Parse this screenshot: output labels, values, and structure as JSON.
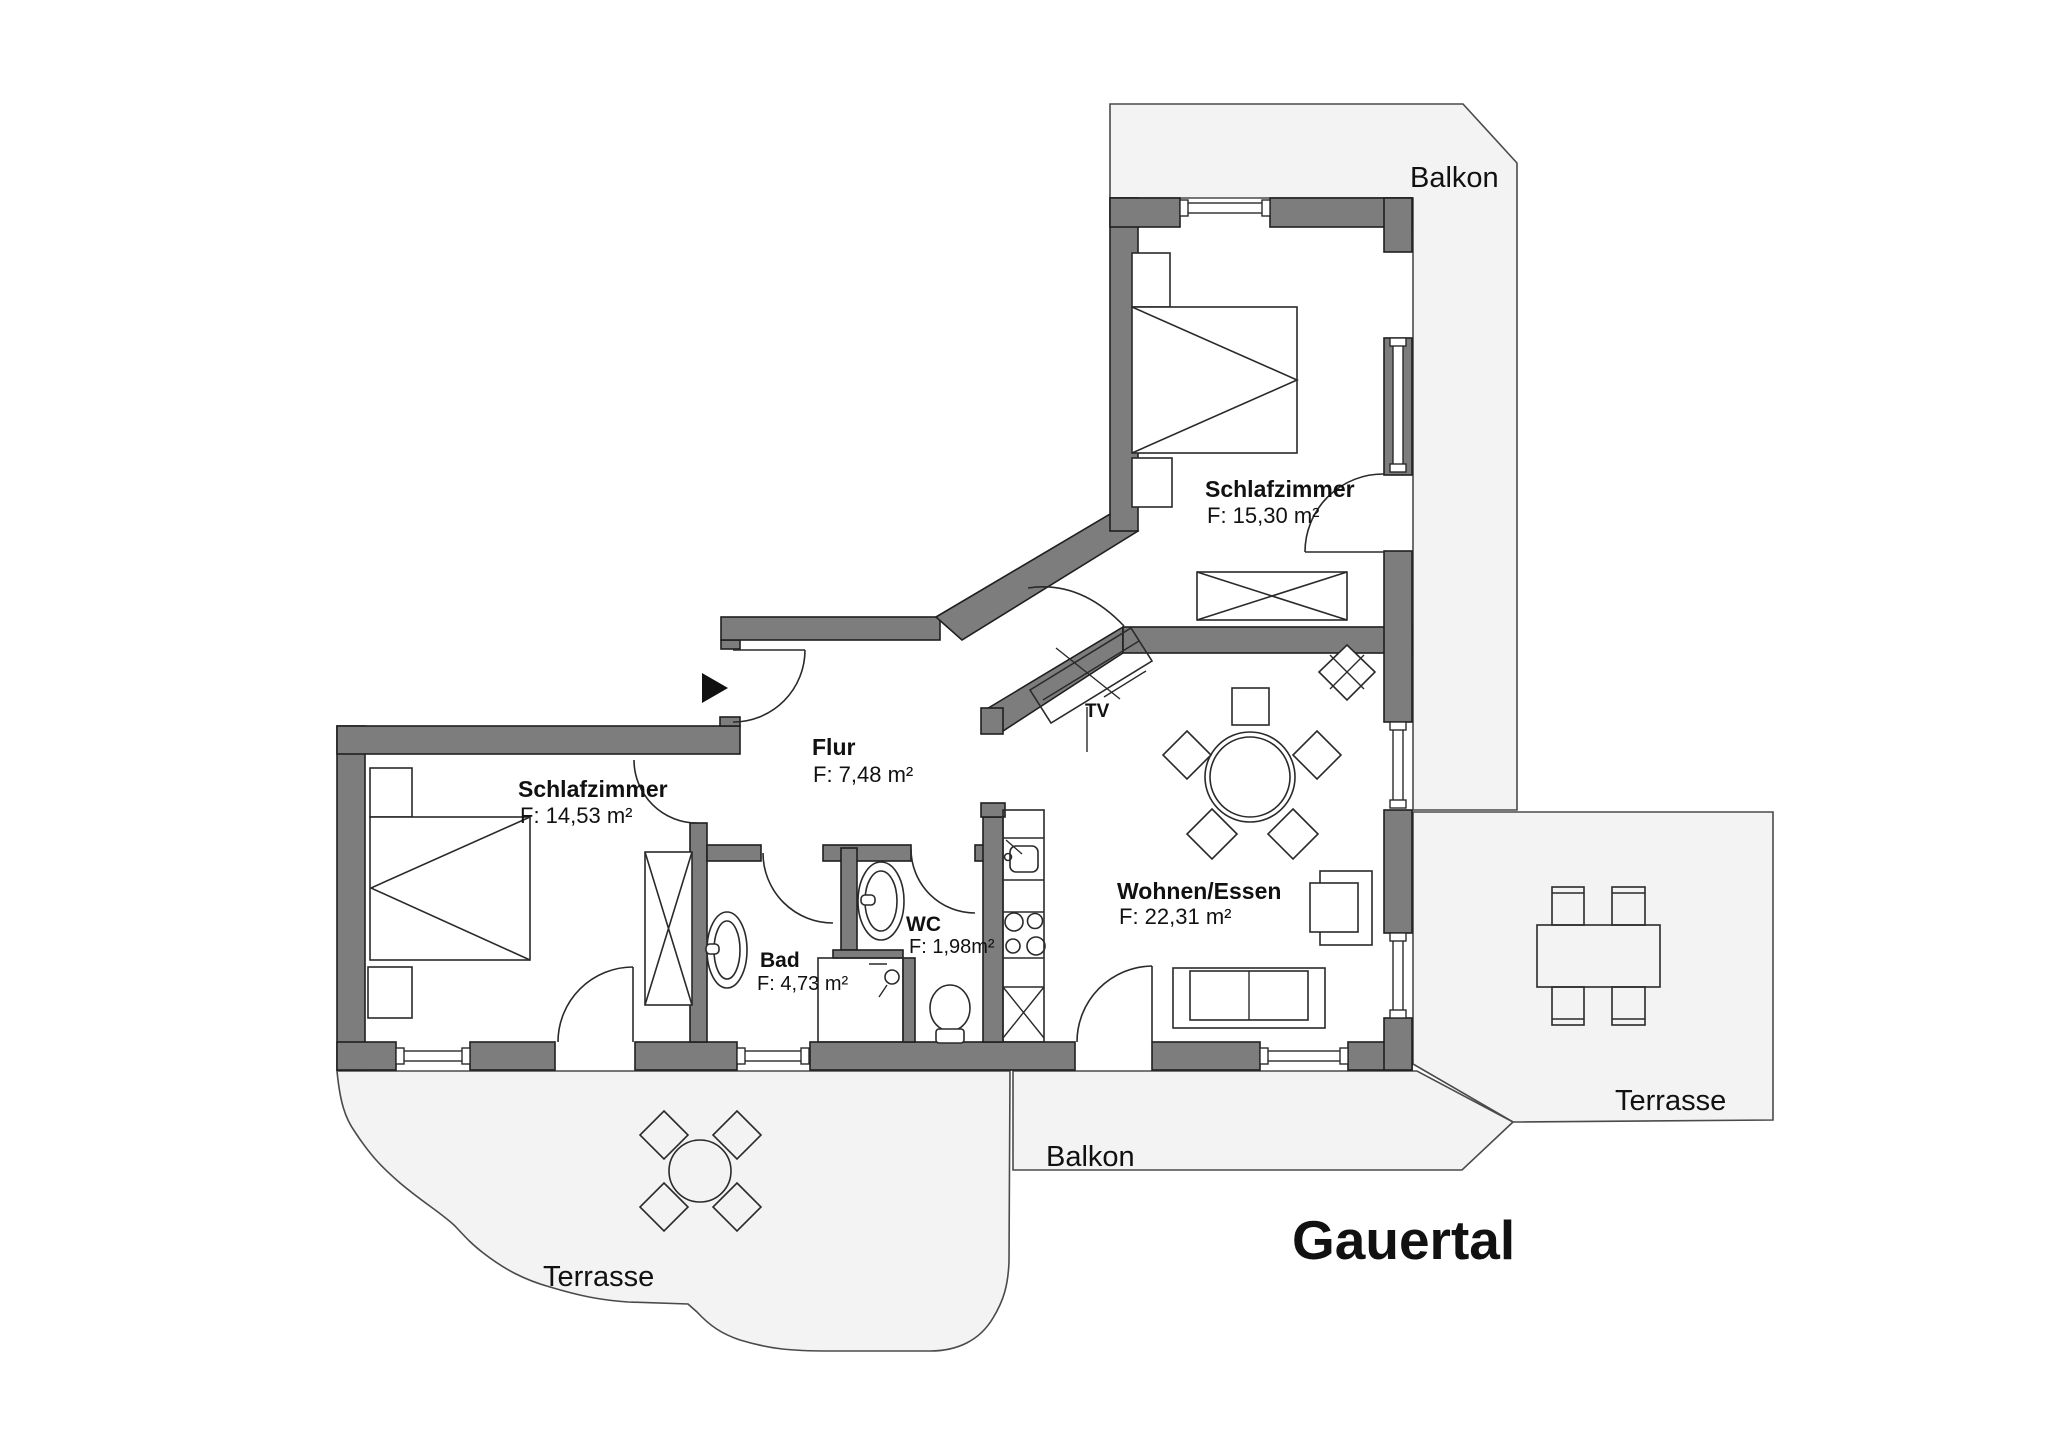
{
  "title": "Gauertal",
  "rooms": {
    "schlafzimmer_top": {
      "label": "Schlafzimmer",
      "area": "F: 15,30 m²"
    },
    "schlafzimmer_left": {
      "label": "Schlafzimmer",
      "area": "F: 14,53 m²"
    },
    "flur": {
      "label": "Flur",
      "area": "F: 7,48  m²"
    },
    "bad": {
      "label": "Bad",
      "area": "F: 4,73 m²"
    },
    "wc": {
      "label": "WC",
      "area": "F: 1,98m²"
    },
    "wohnen_essen": {
      "label": "Wohnen/Essen",
      "area": "F: 22,31 m²"
    }
  },
  "outdoor": {
    "balkon_top": "Balkon",
    "balkon_bottom": "Balkon",
    "terrasse_left": "Terrasse",
    "terrasse_right": "Terrasse"
  },
  "labels": {
    "tv": "TV"
  },
  "colors": {
    "wall": "#7d7d7d",
    "outdoor_fill": "#f3f3f3",
    "line": "#2a2a2a",
    "text": "#111111"
  }
}
